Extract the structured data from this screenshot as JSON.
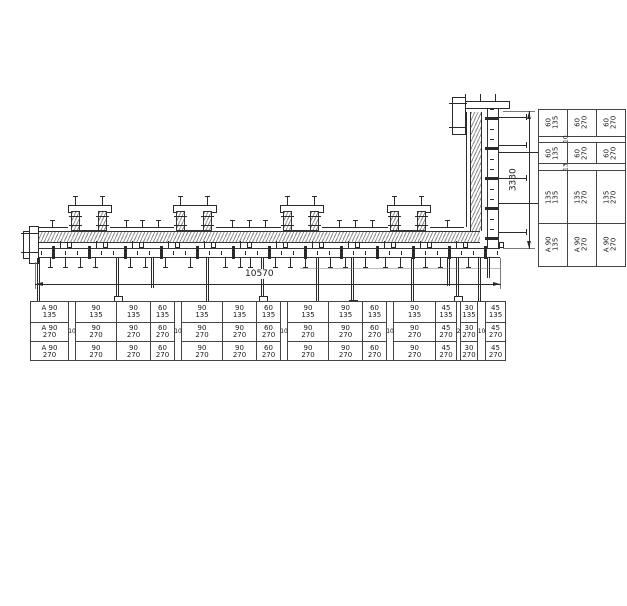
{
  "drawing": {
    "name": "wall-formwork-plan",
    "dim_length_label": "10570",
    "dim_height_label": "3330"
  },
  "bottom_table": {
    "row_suffixes": [
      "135",
      "270",
      "270"
    ],
    "columns": [
      {
        "kind": "panel",
        "label": "A 90",
        "w": 38
      },
      {
        "kind": "filler",
        "label": "10",
        "w": 7
      },
      {
        "kind": "panel",
        "label": "90",
        "w": 41
      },
      {
        "kind": "panel",
        "label": "90",
        "w": 34
      },
      {
        "kind": "panel",
        "label": "60",
        "w": 24
      },
      {
        "kind": "filler",
        "label": "10",
        "w": 7
      },
      {
        "kind": "panel",
        "label": "90",
        "w": 41
      },
      {
        "kind": "panel",
        "label": "90",
        "w": 34
      },
      {
        "kind": "panel",
        "label": "60",
        "w": 24
      },
      {
        "kind": "filler",
        "label": "10",
        "w": 7
      },
      {
        "kind": "panel",
        "label": "90",
        "w": 41
      },
      {
        "kind": "panel",
        "label": "90",
        "w": 34
      },
      {
        "kind": "panel",
        "label": "60",
        "w": 24
      },
      {
        "kind": "filler",
        "label": "10",
        "w": 7
      },
      {
        "kind": "panel",
        "label": "90",
        "w": 42
      },
      {
        "kind": "panel",
        "label": "45",
        "w": 21
      },
      {
        "kind": "filler",
        "label": "2",
        "w": 4
      },
      {
        "kind": "panel",
        "label": "30",
        "w": 17
      },
      {
        "kind": "filler",
        "label": "10",
        "w": 8
      },
      {
        "kind": "panel",
        "label": "45",
        "w": 19
      }
    ]
  },
  "right_table": {
    "rows": [
      {
        "kind": "panel",
        "label": "60",
        "cols": [
          "135",
          "270",
          "270"
        ],
        "h": 27
      },
      {
        "kind": "filler",
        "label": "10",
        "h": 6
      },
      {
        "kind": "panel",
        "label": "60",
        "cols": [
          "135",
          "270",
          "270"
        ],
        "h": 22
      },
      {
        "kind": "filler",
        "label": "13",
        "h": 7
      },
      {
        "kind": "panel",
        "label": "135",
        "cols": [
          "135",
          "270",
          "270"
        ],
        "h": 53
      },
      {
        "kind": "panel",
        "label": "A 90",
        "cols": [
          "135",
          "270",
          "270"
        ],
        "h": 43
      }
    ]
  }
}
